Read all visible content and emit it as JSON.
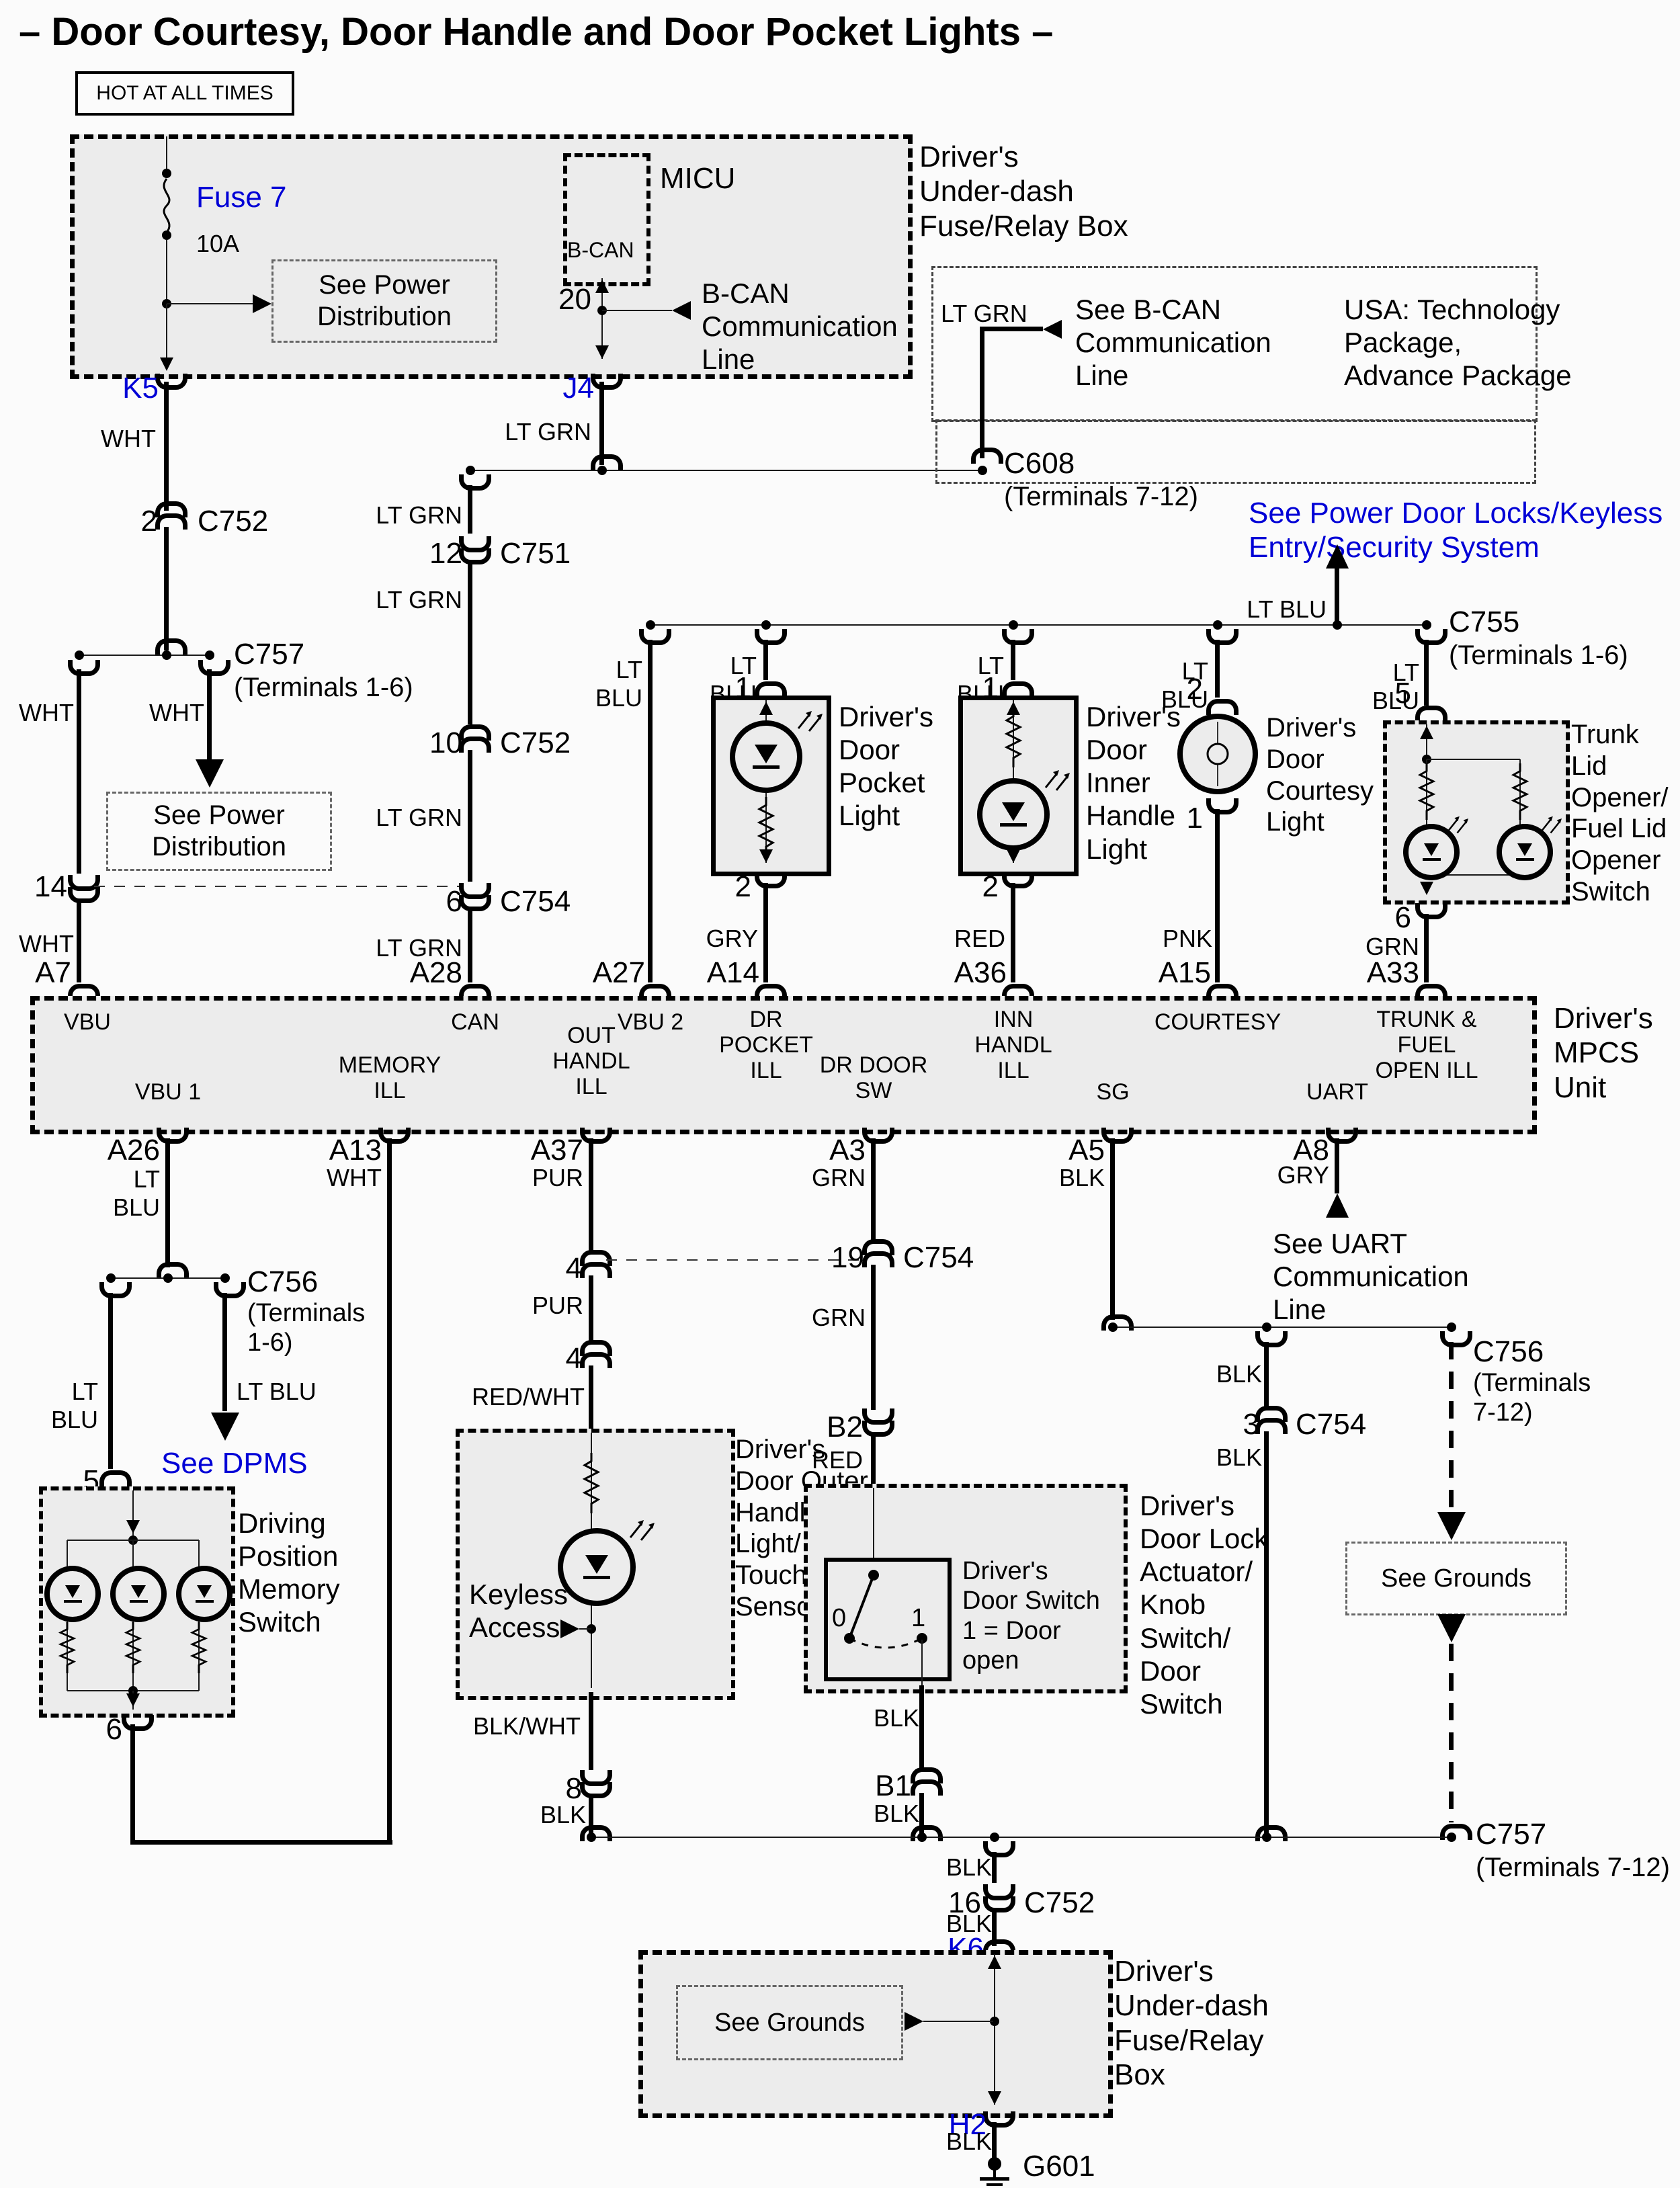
{
  "title": "– Door Courtesy, Door Handle and Door Pocket Lights –",
  "colors": {
    "wht": "WHT",
    "lt_grn": "LT GRN",
    "lt_blu": "LT BLU",
    "gry": "GRY",
    "red": "RED",
    "pnk": "PNK",
    "grn": "GRN",
    "blk": "BLK",
    "pur": "PUR",
    "red_wht": "RED/WHT",
    "blk_wht": "BLK/WHT"
  },
  "connectors": {
    "c751": "C751",
    "c752": "C752",
    "c754": "C754",
    "c755": "C755",
    "c756": "C756",
    "c757": "C757",
    "c608": "C608",
    "t16": "(Terminals 1-6)",
    "t16m": "(Terminals\n1-6)",
    "t712": "(Terminals 7-12)",
    "t712m": "(Terminals\n7-12)"
  },
  "pins": {
    "p0": "0",
    "p1": "1",
    "p2": "2",
    "p3": "3",
    "p4": "4",
    "p5": "5",
    "p6": "6",
    "p8": "8",
    "p10": "10",
    "p12": "12",
    "p14": "14",
    "p16": "16",
    "p19": "19",
    "p20": "20",
    "k5": "K5",
    "j4": "J4",
    "k6": "K6",
    "h2": "H2",
    "b1": "B1",
    "b2": "B2",
    "a3": "A3",
    "a5": "A5",
    "a7": "A7",
    "a8": "A8",
    "a13": "A13",
    "a14": "A14",
    "a15": "A15",
    "a26": "A26",
    "a27": "A27",
    "a28": "A28",
    "a33": "A33",
    "a36": "A36",
    "a37": "A37"
  },
  "fuse": {
    "name": "Fuse 7",
    "rating": "10A"
  },
  "boxes": {
    "hot": "HOT AT ALL TIMES",
    "micu": "MICU",
    "bcan": "B-CAN",
    "udfrb_top": "Driver's\nUnder-dash\nFuse/Relay Box",
    "udfrb_bottom": "Driver's\nUnder-dash\nFuse/Relay\nBox",
    "mpcs": "Driver's\nMPCS Unit"
  },
  "mpcs_pins": {
    "vbu": "VBU",
    "can": "CAN",
    "vbu2": "VBU 2",
    "dr_pocket_ill": "DR\nPOCKET\nILL",
    "inn_handl_ill": "INN\nHANDL\nILL",
    "courtesy": "COURTESY",
    "trunk_fuel": "TRUNK &\nFUEL\nOPEN ILL",
    "vbu1": "VBU 1",
    "memory_ill": "MEMORY\nILL",
    "out_handl_ill": "OUT\nHANDL\nILL",
    "dr_door_sw": "DR DOOR\nSW",
    "sg": "SG",
    "uart": "UART"
  },
  "components": {
    "pocket": "Driver's\nDoor\nPocket\nLight",
    "inner": "Driver's\nDoor\nInner\nHandle\nLight",
    "courtesy": "Driver's\nDoor\nCourtesy\nLight",
    "trunk": "Trunk Lid\nOpener/\nFuel Lid\nOpener\nSwitch",
    "dpms": "Driving\nPosition\nMemory\nSwitch",
    "outer": "Driver's\nDoor Outer\nHandle\nLight/\nTouch\nSensor",
    "keyless": "Keyless\nAccess",
    "door_switch": "Driver's\nDoor Switch\n1 = Door\nopen",
    "door_lock": "Driver's\nDoor Lock\nActuator/\nKnob\nSwitch/\nDoor\nSwitch"
  },
  "notes": {
    "see_power_distribution": "See Power\nDistribution",
    "bcan_line": "B-CAN\nCommunication\nLine",
    "see_bcan": "See B-CAN\nCommunication\nLine",
    "usa": "USA: Technology\nPackage,\nAdvance Package",
    "see_pdl": "See Power Door Locks/Keyless\nEntry/Security System",
    "see_dpms": "See DPMS",
    "see_grounds": "See Grounds",
    "see_uart": "See UART\nCommunication\nLine",
    "ground": "G601"
  }
}
